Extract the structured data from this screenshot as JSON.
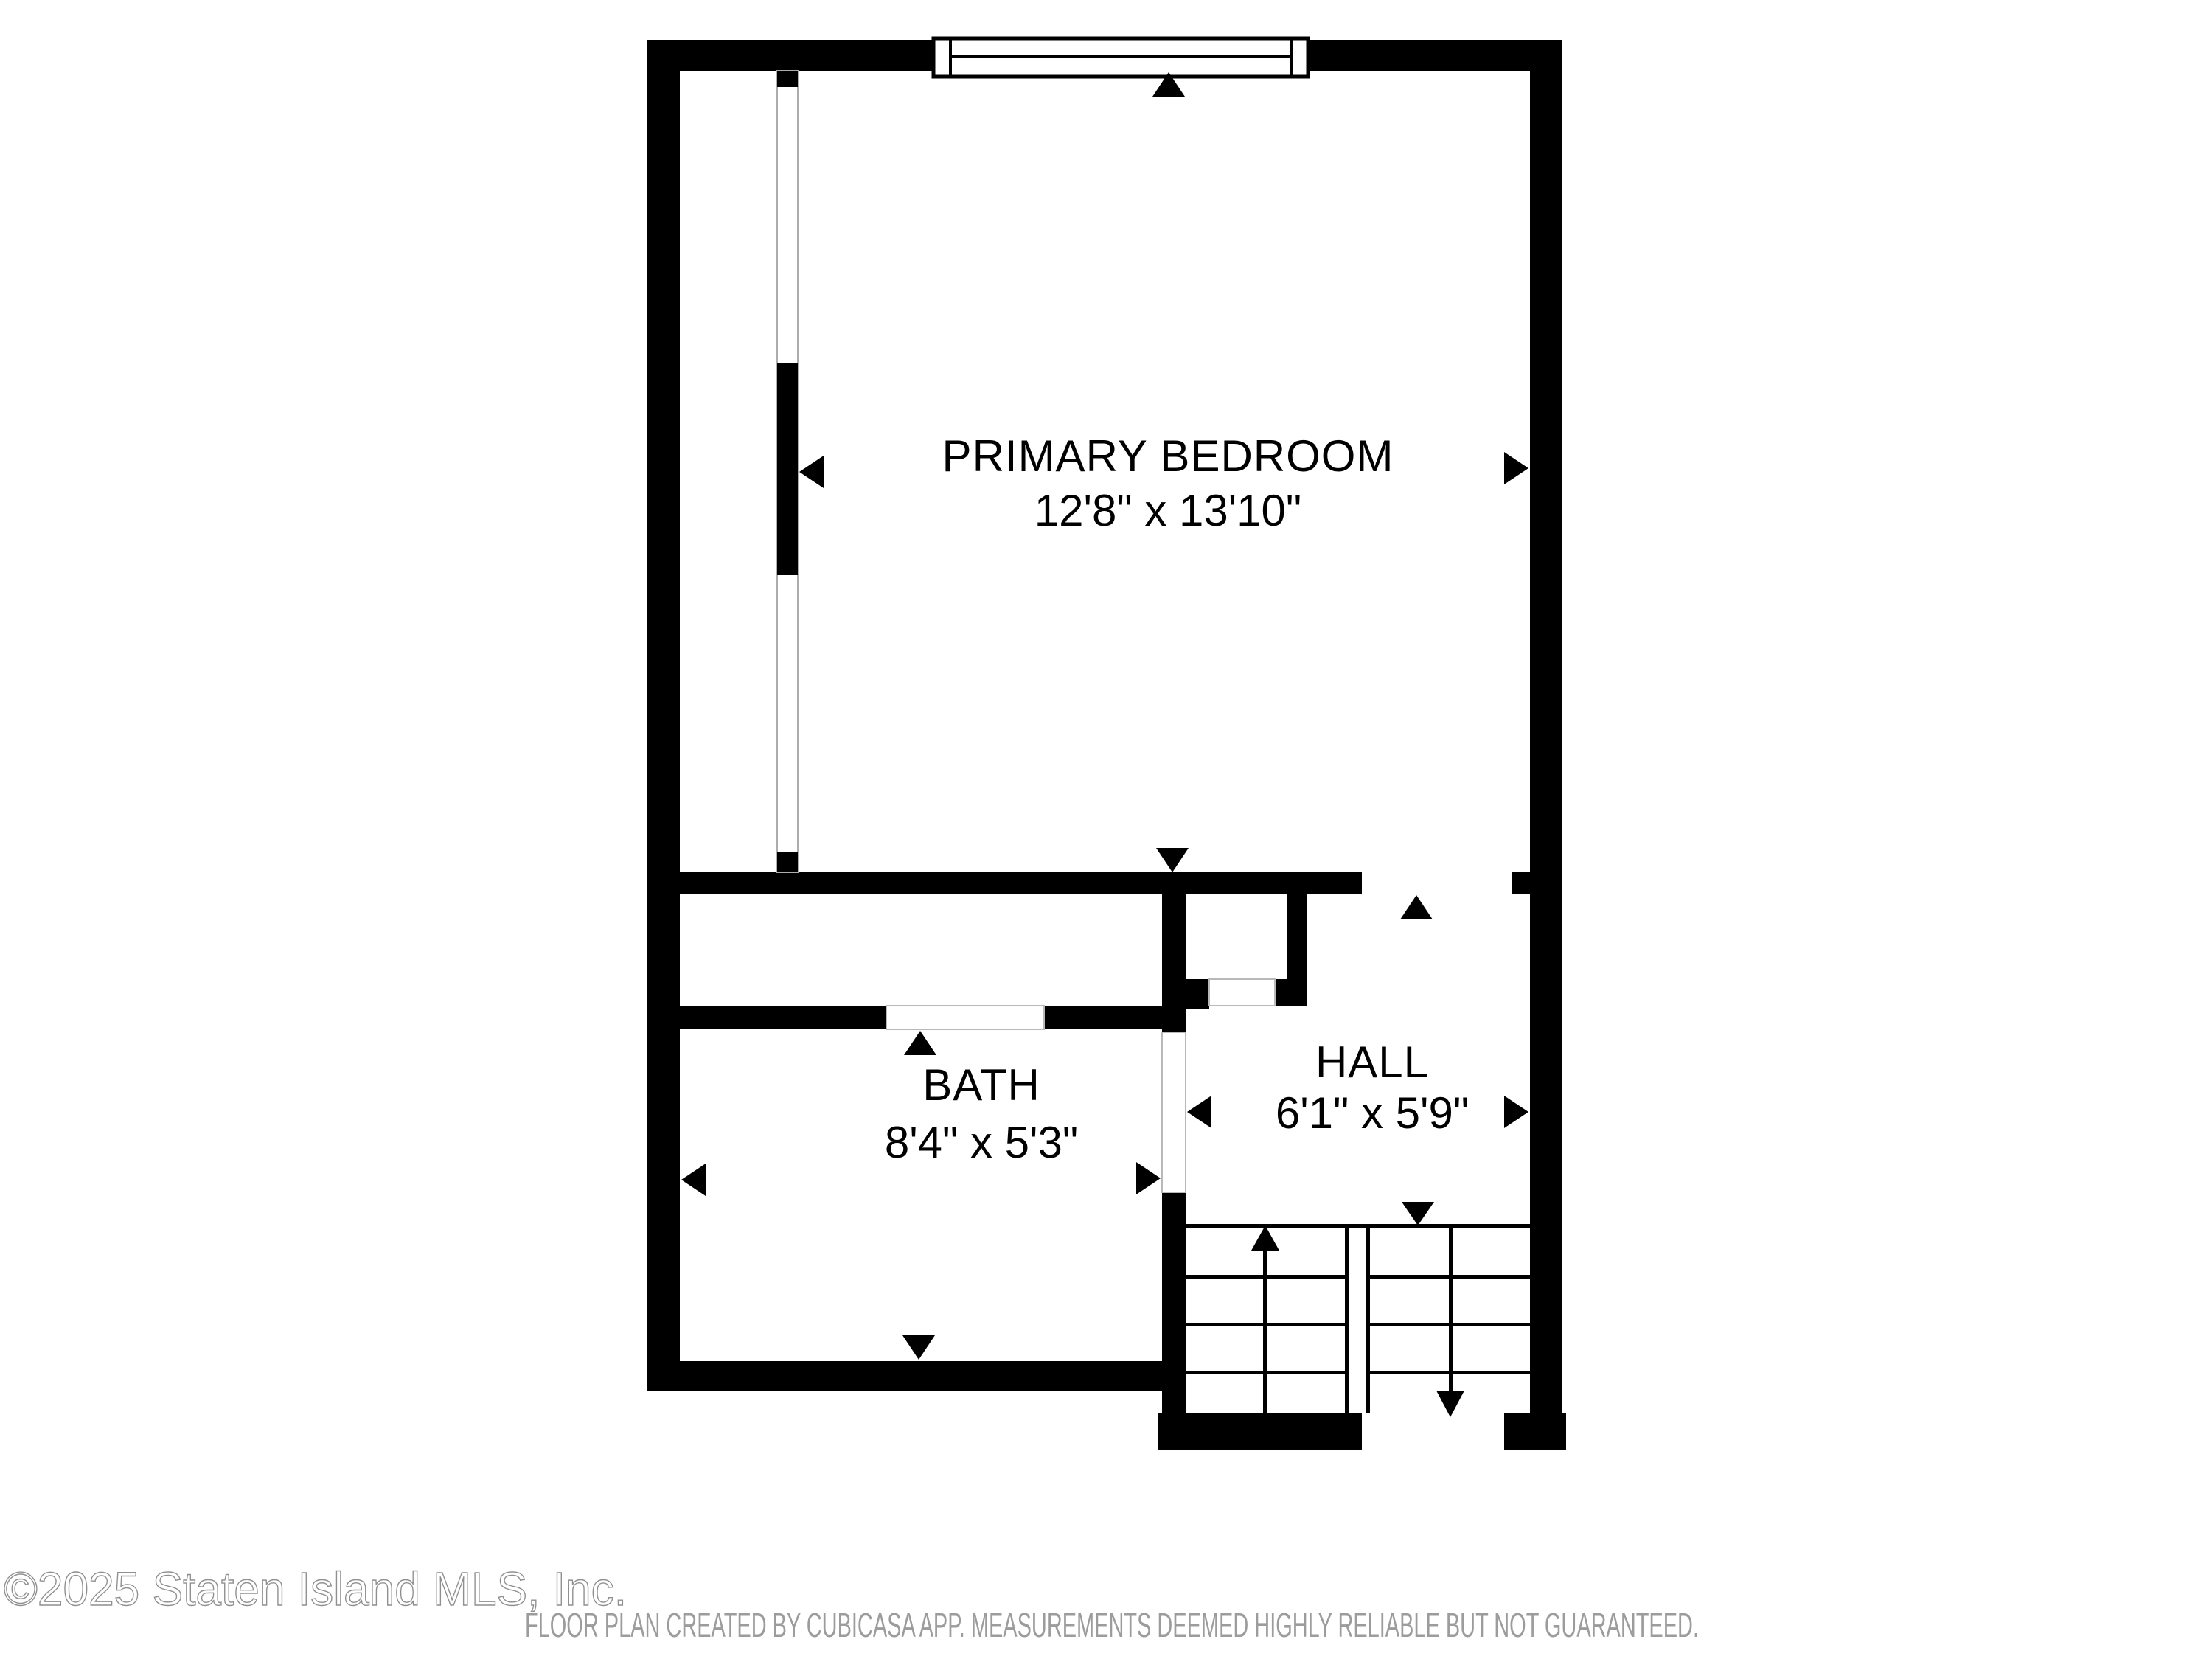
{
  "plan": {
    "type": "floor-plan",
    "rooms": [
      {
        "id": "primary_bedroom",
        "label": "PRIMARY BEDROOM",
        "dimensions": "12'8\" x 13'10\""
      },
      {
        "id": "bath",
        "label": "BATH",
        "dimensions": "8'4\" x 5'3\""
      },
      {
        "id": "hall",
        "label": "HALL",
        "dimensions": "6'1\" x 5'9\""
      }
    ],
    "features": {
      "window_count": 1,
      "door_openings": 4,
      "stairs": {
        "flights": 2,
        "up_icon": "arrow-up",
        "down_icon": "arrow-down"
      },
      "dimension_marker_icons": [
        "triangle-up",
        "triangle-down",
        "triangle-left",
        "triangle-right"
      ]
    },
    "colors": {
      "wall": "#000000",
      "floor": "#ffffff",
      "door_outline": "#b9b9b9",
      "label_text": "#000000",
      "footer_text": "#9c9c9c",
      "watermark_outline": "#8f8f8f"
    }
  },
  "watermark": {
    "text": "©2025 Staten Island MLS, Inc."
  },
  "footer": {
    "text": "FLOOR PLAN CREATED BY CUBICASA APP. MEASUREMENTS DEEMED HIGHLY RELIABLE BUT NOT GUARANTEED."
  }
}
